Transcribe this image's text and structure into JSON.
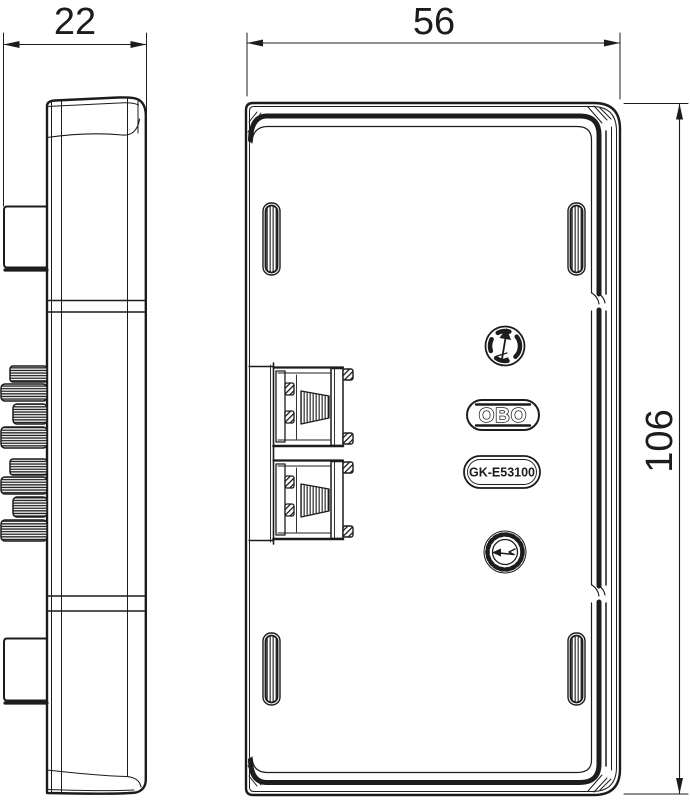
{
  "drawing": {
    "type": "technical-drawing",
    "dimensions": {
      "side_width_mm": "22",
      "front_width_mm": "56",
      "front_height_mm": "106"
    },
    "labels": {
      "brand": "OBO",
      "product_code": "GK-E53100"
    },
    "icons": {
      "upper": "screw-direction-indicator",
      "lower": "adjustment-wheel"
    },
    "colors": {
      "line": "#1c1c1c",
      "background": "#ffffff"
    }
  }
}
